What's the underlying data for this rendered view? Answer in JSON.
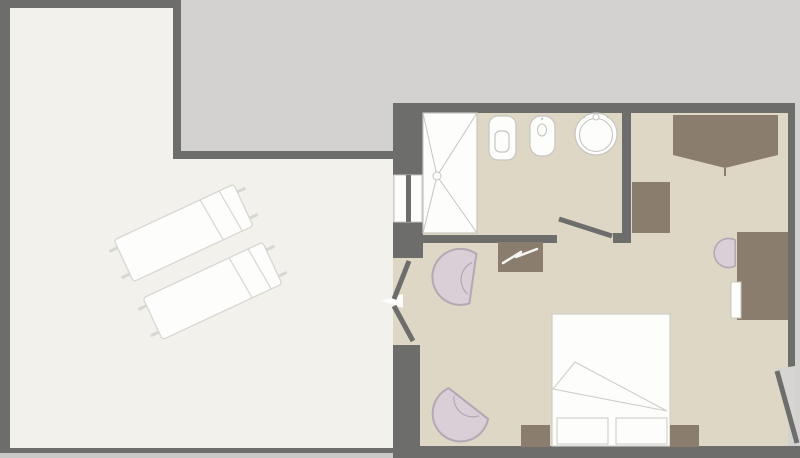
{
  "canvas": {
    "width": 800,
    "height": 458
  },
  "colors": {
    "wall": "#6d6d6b",
    "terrace_floor": "#f2f1ec",
    "neighbor_area": "#d3d2d0",
    "outside_strip": "#c9c9c7",
    "room_floor": "#ded7c5",
    "furniture_brown": "#8a7d6e",
    "chair_fill": "#d8cfd7",
    "chair_stroke": "#b3a8b3",
    "fixture_fill": "#fdfdfc",
    "fixture_stroke": "#c6c5c0",
    "bed_stroke": "#cfcec9",
    "lounger_stroke": "#d8d7d2",
    "door_swing": "#d6d5d3",
    "strap_white": "#f5f4f0"
  },
  "floor_plan": {
    "type": "hotel-room-floor-plan",
    "rooms": [
      {
        "id": "terrace",
        "name": "terrace"
      },
      {
        "id": "bathroom",
        "name": "bathroom"
      },
      {
        "id": "bedroom",
        "name": "bedroom"
      },
      {
        "id": "adjacent-area",
        "name": "adjacent-grayed-area"
      }
    ],
    "fixtures": [
      "shower",
      "toilet",
      "bidet",
      "washbasin"
    ],
    "furniture": [
      "sun-lounger",
      "sun-lounger",
      "armchair",
      "armchair",
      "luggage-bench",
      "wardrobe",
      "side-cabinet",
      "desk",
      "desk-chair",
      "double-bed",
      "pillow",
      "pillow",
      "nightstand",
      "nightstand"
    ],
    "doors": [
      "terrace-double-door",
      "bathroom-door",
      "entrance-door"
    ],
    "windows": [
      "bathroom-window"
    ]
  }
}
